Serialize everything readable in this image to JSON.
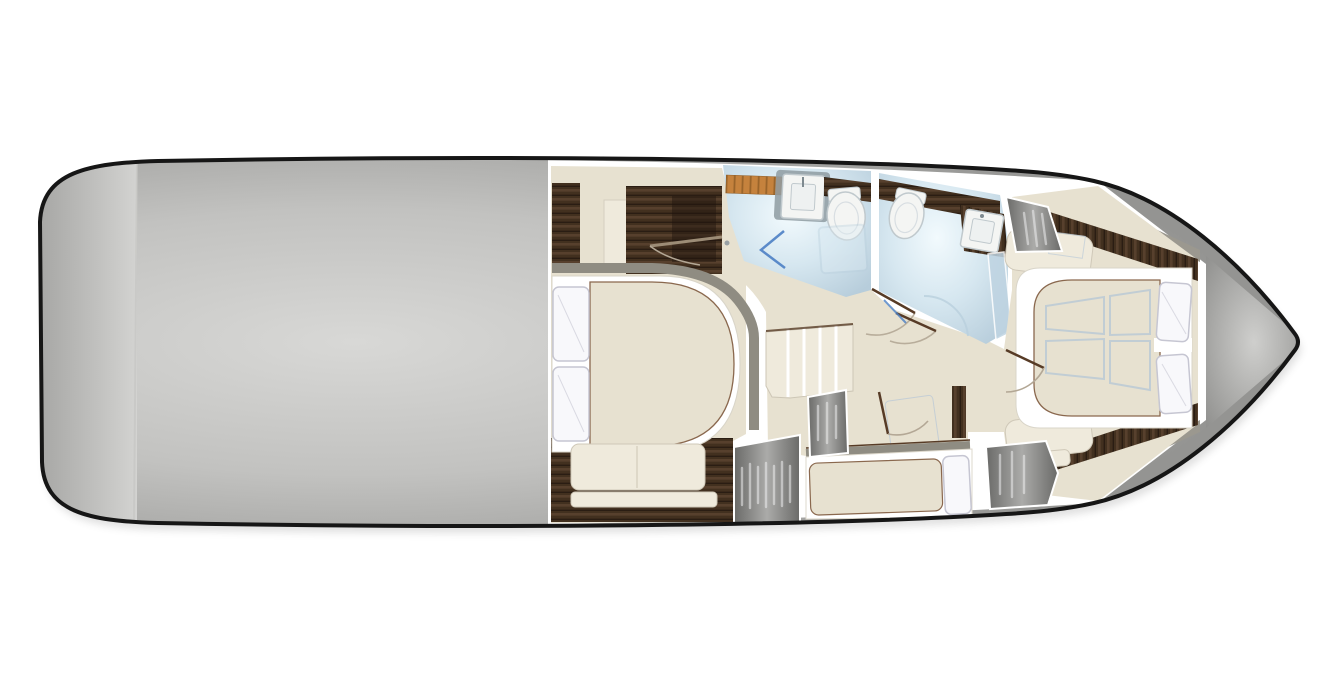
{
  "colors": {
    "background": "#ffffff",
    "outline": "#161616",
    "hull_center": "#d8d8d6",
    "hull_mid": "#c2c2c0",
    "hull_edge": "#949492",
    "stern_band_left": "#a6a6a4",
    "stern_band_right": "#d3d3d1",
    "bow_center": "#cfcfcd",
    "bow_edge": "#8f8f8d",
    "deck_white": "#ffffff",
    "floor_cream": "#e7e1d0",
    "floor_cream_light": "#efeadc",
    "wall_gray": "#8f8c82",
    "hull_strip_gray": "#9b988f",
    "wood_dark": "#42301f",
    "wood_streak": "#5f4833",
    "wood_shadow": "#241810",
    "teak": "#c5823d",
    "teak_line": "#8e5c26",
    "bath_center": "#f2fafd",
    "bath_mid": "#d6e7f0",
    "bath_edge": "#b7cddb",
    "fixture_white": "#f4f5f3",
    "fixture_line": "#c0c9cd",
    "fixture_shadow": "#8e9ba1",
    "pillow_white": "#f8f8fb",
    "pillow_line": "#c6c6d2",
    "closet_dark": "#6a6a68",
    "closet_light": "#ababa9",
    "hanger_white": "#eeeeef",
    "door_leaf": "#573b26",
    "arc_line": "#b3a795",
    "glass_blue": "#4d80c4",
    "glass_pane": "#bfd4e2",
    "blanket_blue": "#a9c0d8",
    "bed_outline": "#8a684e"
  }
}
